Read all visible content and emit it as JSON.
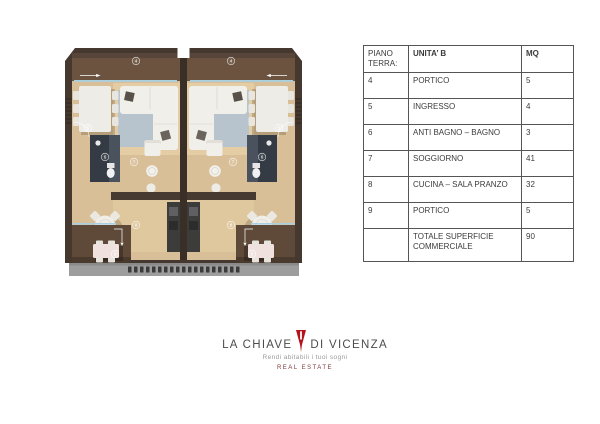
{
  "plan": {
    "unit_labels": [
      "4",
      "5",
      "6",
      "7",
      "8",
      "9"
    ]
  },
  "table": {
    "col_floor": "PIANO TERRA:",
    "col_unit": "UNITA’ B",
    "col_mq": "MQ",
    "rows": [
      {
        "num": "4",
        "name": "PORTICO",
        "mq": "5"
      },
      {
        "num": "5",
        "name": "INGRESSO",
        "mq": "4"
      },
      {
        "num": "6",
        "name": "ANTI BAGNO – BAGNO",
        "mq": "3"
      },
      {
        "num": "7",
        "name": "SOGGIORNO",
        "mq": "41"
      },
      {
        "num": "8",
        "name": "CUCINA – SALA PRANZO",
        "mq": "32"
      },
      {
        "num": "9",
        "name": "PORTICO",
        "mq": "5"
      },
      {
        "num": "",
        "name": "TOTALE SUPERFICIE COMMERCIALE",
        "mq": "90"
      }
    ]
  },
  "logo": {
    "title_left": "LA CHIAVE",
    "title_right": "DI VICENZA",
    "tagline": "Rendi abitabili i tuoi sogni",
    "subtitle": "REAL ESTATE"
  },
  "colors": {
    "brand_red": "#b5121b",
    "text_dark": "#3b3b3b",
    "wood": "#d8bf97",
    "porch_brown": "#6b533f",
    "wall_dark": "#44382f",
    "glass_blue": "#a9d0e2"
  }
}
